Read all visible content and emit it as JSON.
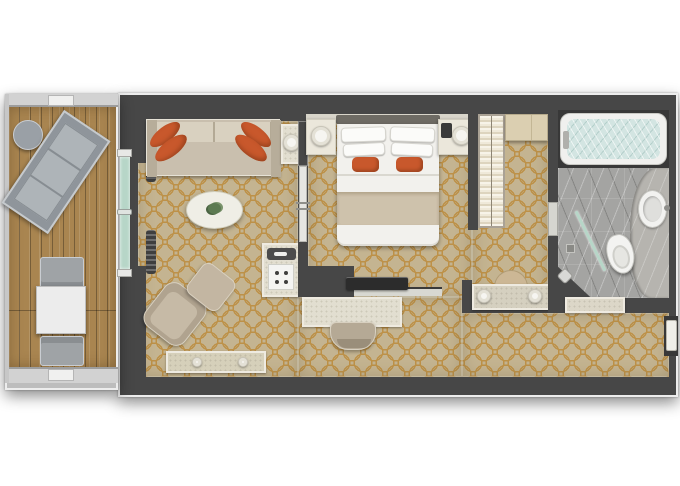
{
  "meta": {
    "type": "floor-plan",
    "description": "Top-down 3D rendered floor plan of a hotel suite: balcony with deck furniture, living room, bedroom, dressing area with wardrobe and vanity, marble bathroom, and entry hallway",
    "canvas_width": 680,
    "canvas_height": 486
  },
  "palette": {
    "bg": "#ffffff",
    "wall": "#474747",
    "wall_dark": "#383838",
    "trim": "#ededed",
    "carpet": "#c4b491",
    "carpet_line": "#bd9148",
    "wood": "#a98550",
    "sofa": "#c9bfae",
    "sofa_light": "#d9d1c0",
    "orange": "#c8582c",
    "orange_dark": "#9e4520",
    "marble": "#e2ded0",
    "marble_border": "#eeeae0",
    "bath_floor": "#a4a4a2",
    "bath_counter": "#b6b4af",
    "water": "#d3e5e2",
    "glass": "#b7d6c8",
    "bed_white": "#f2f1ed",
    "runner": "#cec2ac",
    "wardrobe_a": "#f7f3e8",
    "wardrobe_b": "#ddd4be",
    "cabinet_wood": "#dbcfb1",
    "stool": "#b5a995",
    "rail": "#d2d2d2"
  },
  "rooms": [
    {
      "name": "balcony",
      "floor": "wood deck",
      "furniture": [
        "sun-lounger",
        "round-side-table",
        "outdoor-dining-table",
        "outdoor-chair x2",
        "railing"
      ]
    },
    {
      "name": "living-room",
      "floor": "patterned carpet",
      "furniture": [
        "sofa with 4 orange pillows",
        "side-table with lamp",
        "oval coffee-table with plant",
        "armchair",
        "ottoman",
        "bench with ornaments",
        "minibar cabinet with tray and espresso machine",
        "curtains",
        "sliding glass balcony door"
      ]
    },
    {
      "name": "bedroom",
      "floor": "patterned carpet",
      "furniture": [
        "double bed with white duvet, runner and orange pillows",
        "headboard",
        "nightstand x2 with lamps",
        "phone",
        "sliding door to living room",
        "tv on partition wall",
        "desk",
        "desk-chair"
      ]
    },
    {
      "name": "dressing-area",
      "floor": "patterned carpet",
      "furniture": [
        "wardrobe with hanging clothes",
        "closet cabinet",
        "vanity counter with two lamps",
        "vanity stool"
      ]
    },
    {
      "name": "bathroom",
      "floor": "gray marble tile",
      "furniture": [
        "bathtub filled with water",
        "curved counter",
        "oval washbasin",
        "toilet",
        "glass shower panel",
        "shower drain",
        "shower fixture"
      ]
    },
    {
      "name": "entry-hallway",
      "floor": "patterned carpet",
      "furniture": [
        "console table",
        "entry door"
      ]
    }
  ]
}
